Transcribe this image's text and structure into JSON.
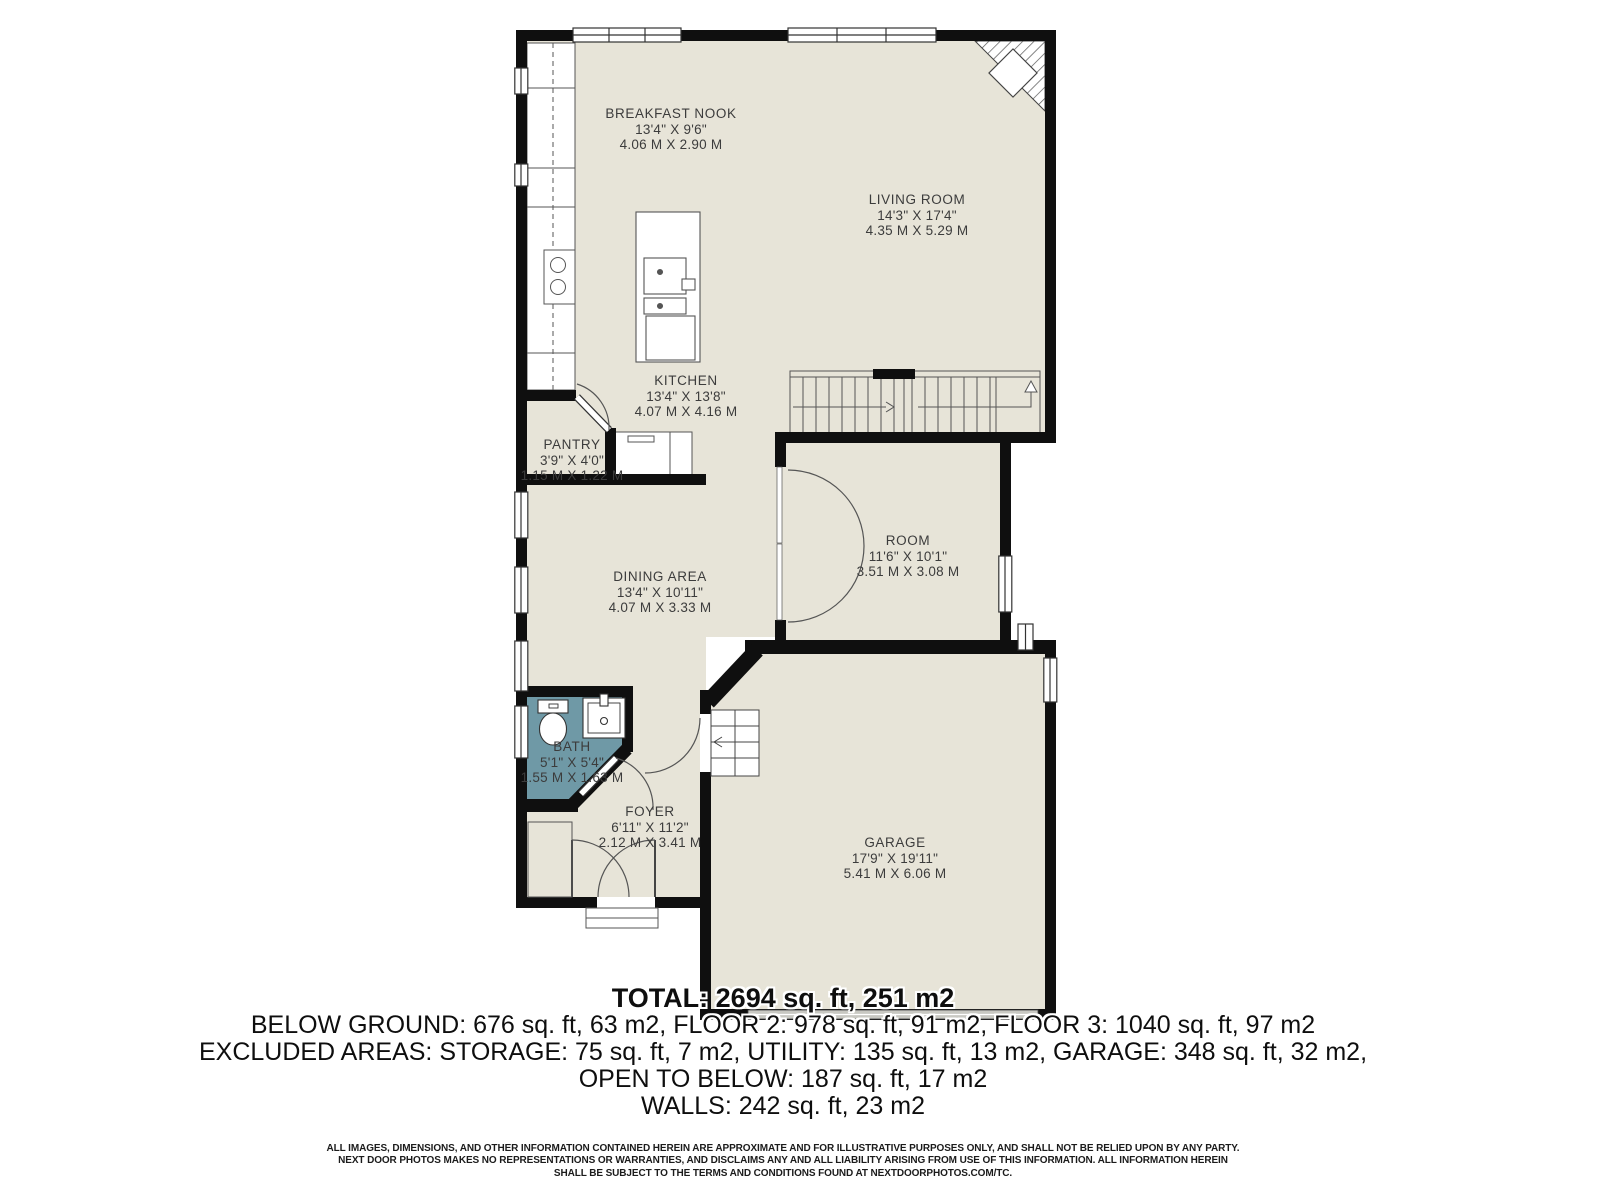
{
  "colors": {
    "floor": "#e7e4d8",
    "bath_floor": "#6f99a6",
    "wall": "#0f0f0f",
    "garage_door_gray": "#c8c8c2"
  },
  "rooms": [
    {
      "id": "breakfast-nook",
      "name": "BREAKFAST NOOK",
      "dims_ft": "13'4\" X 9'6\"",
      "dims_m": "4.06 M X 2.90 M"
    },
    {
      "id": "living-room",
      "name": "LIVING ROOM",
      "dims_ft": "14'3\" X 17'4\"",
      "dims_m": "4.35 M X 5.29 M"
    },
    {
      "id": "kitchen",
      "name": "KITCHEN",
      "dims_ft": "13'4\" X 13'8\"",
      "dims_m": "4.07 M X 4.16 M"
    },
    {
      "id": "pantry",
      "name": "PANTRY",
      "dims_ft": "3'9\" X 4'0\"",
      "dims_m": "1.15 M X 1.22 M"
    },
    {
      "id": "room",
      "name": "ROOM",
      "dims_ft": "11'6\" X 10'1\"",
      "dims_m": "3.51 M X 3.08 M"
    },
    {
      "id": "dining-area",
      "name": "DINING AREA",
      "dims_ft": "13'4\" X 10'11\"",
      "dims_m": "4.07 M X 3.33 M"
    },
    {
      "id": "bath",
      "name": "BATH",
      "dims_ft": "5'1\" X 5'4\"",
      "dims_m": "1.55 M X 1.63 M"
    },
    {
      "id": "foyer",
      "name": "FOYER",
      "dims_ft": "6'11\" X 11'2\"",
      "dims_m": "2.12 M X 3.41 M"
    },
    {
      "id": "garage",
      "name": "GARAGE",
      "dims_ft": "17'9\" X 19'11\"",
      "dims_m": "5.41 M X 6.06 M"
    }
  ],
  "summary": {
    "total": "TOTAL: 2694 sq. ft, 251 m2",
    "lines": [
      "BELOW GROUND: 676 sq. ft, 63 m2, FLOOR 2: 978 sq. ft, 91 m2, FLOOR 3: 1040 sq. ft, 97 m2",
      "EXCLUDED AREAS: STORAGE: 75 sq. ft, 7 m2, UTILITY: 135 sq. ft, 13 m2, GARAGE: 348 sq. ft, 32 m2,",
      "OPEN TO BELOW: 187 sq. ft, 17 m2",
      "WALLS: 242 sq. ft, 23 m2"
    ]
  },
  "disclaimer": {
    "lines": [
      "ALL IMAGES, DIMENSIONS, AND OTHER INFORMATION CONTAINED HEREIN ARE APPROXIMATE AND FOR ILLUSTRATIVE PURPOSES ONLY, AND SHALL NOT BE RELIED UPON BY ANY PARTY.",
      "NEXT DOOR PHOTOS MAKES NO REPRESENTATIONS OR WARRANTIES, AND DISCLAIMS ANY AND ALL LIABILITY ARISING FROM USE OF THIS INFORMATION. ALL INFORMATION HEREIN",
      "SHALL BE SUBJECT TO THE TERMS AND CONDITIONS FOUND AT NEXTDOORPHOTOS.COM/TC."
    ]
  }
}
